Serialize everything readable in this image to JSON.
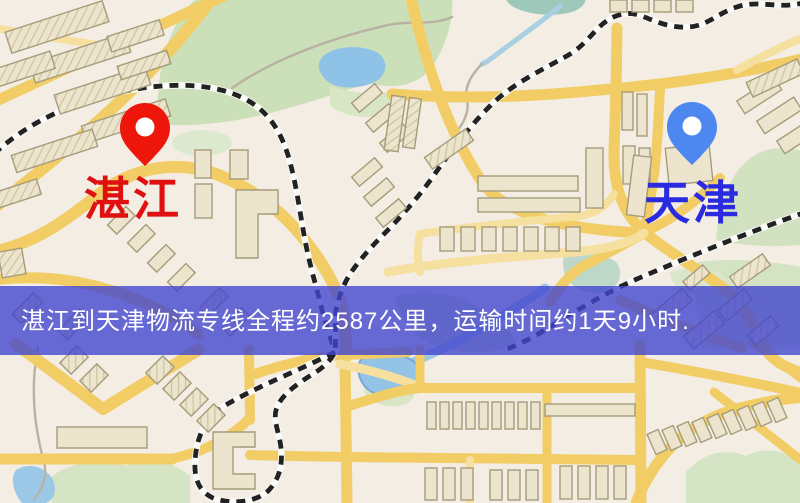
{
  "banner": {
    "text": "湛江到天津物流专线全程约2587公里，运输时间约1天9小时.",
    "background": "rgba(66,70,206,0.8)",
    "text_color": "#ffffff"
  },
  "markers": {
    "origin": {
      "label": "湛江",
      "pin_color": "#ee150a",
      "label_color": "#e01010"
    },
    "destination": {
      "label": "天津",
      "pin_color": "#4d87f0",
      "label_color": "#2a2ae0"
    }
  },
  "route": {
    "origin": "湛江",
    "destination": "天津",
    "distance_km": "2587",
    "duration": "1天9小时"
  },
  "map_palette": {
    "background": "#f3ede4",
    "road": "#f2cd66",
    "road_minor": "#f6e0a0",
    "building_fill": "#ece4cd",
    "building_stroke": "#a59c7a",
    "park": "#cbdfb8",
    "park_light": "#d8e6c6",
    "water": "#8ec2e6",
    "railway": "#222222",
    "railway_casing": "#fafaf7",
    "path": "#b9b2a3"
  }
}
